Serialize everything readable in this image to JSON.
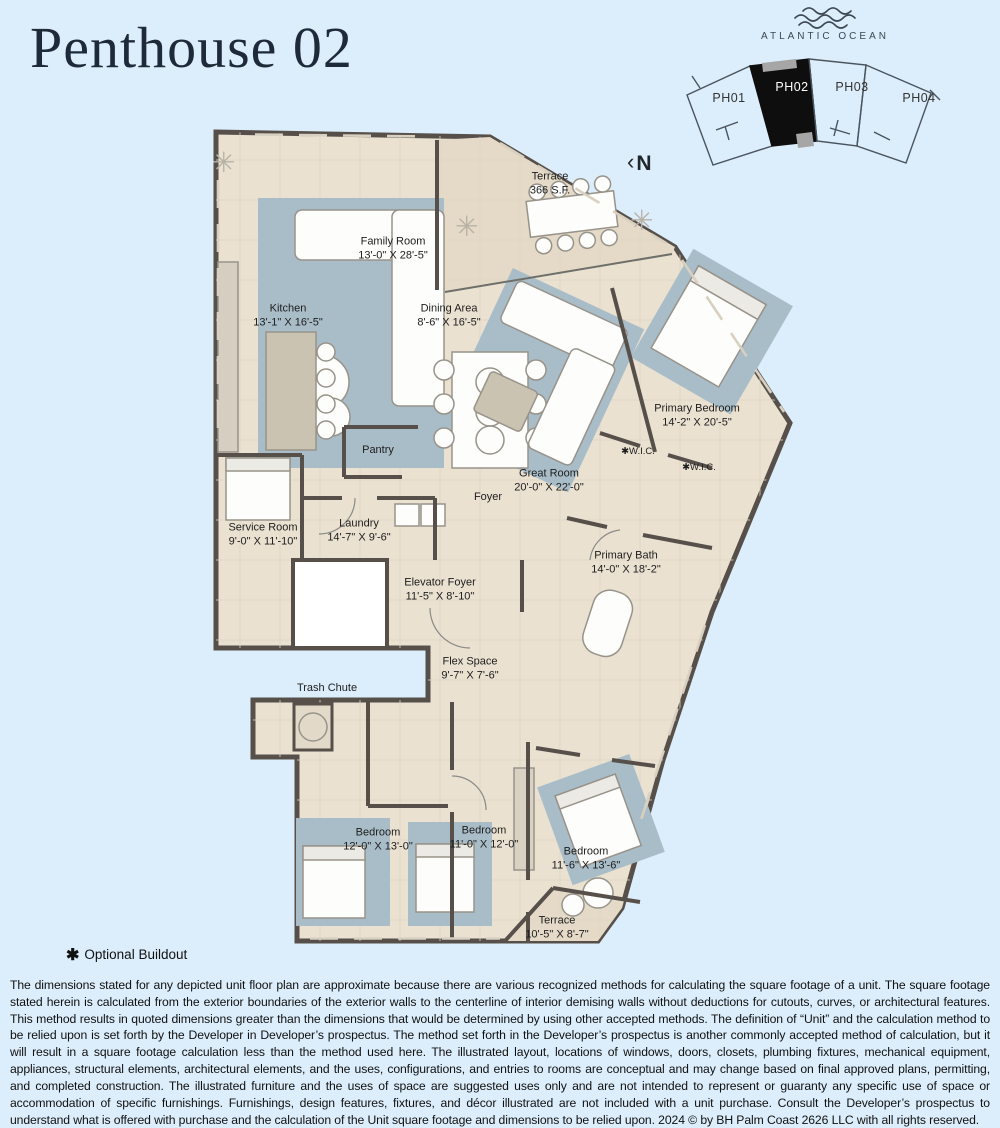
{
  "page": {
    "title": "Penthouse 02"
  },
  "key_plan": {
    "ocean_label": "ATLANTIC OCEAN",
    "north_label": "N",
    "north_chevron": "‹",
    "highlighted_unit": "PH02",
    "units": [
      {
        "id": "PH01"
      },
      {
        "id": "PH02"
      },
      {
        "id": "PH03"
      },
      {
        "id": "PH04"
      }
    ],
    "colors": {
      "highlight_fill": "#0e0e0e",
      "outline": "#4a545e"
    }
  },
  "floor_plan": {
    "rooms": [
      {
        "name": "Terrace",
        "dims": "366 S.F."
      },
      {
        "name": "Family Room",
        "dims": "13'-0\" X 28'-5\""
      },
      {
        "name": "Kitchen",
        "dims": "13'-1\" X 16'-5\""
      },
      {
        "name": "Dining Area",
        "dims": "8'-6\" X 16'-5\""
      },
      {
        "name": "Primary Bedroom",
        "dims": "14'-2\" X 20'-5\""
      },
      {
        "name": "Great Room",
        "dims": "20'-0\" X 22'-0\""
      },
      {
        "name": "✱W.I.C."
      },
      {
        "name": "✱W.I.C."
      },
      {
        "name": "Pantry"
      },
      {
        "name": "Foyer"
      },
      {
        "name": "Service Room",
        "dims": "9'-0\" X 11'-10\""
      },
      {
        "name": "Laundry",
        "dims": "14'-7\" X 9'-6\""
      },
      {
        "name": "Primary Bath",
        "dims": "14'-0\" X 18'-2\""
      },
      {
        "name": "Elevator Foyer",
        "dims": "11'-5\" X 8'-10\""
      },
      {
        "name": "Flex Space",
        "dims": "9'-7\" X 7'-6\""
      },
      {
        "name": "Trash Chute"
      },
      {
        "name": "Bedroom",
        "dims": "12'-0\" X 13'-0\""
      },
      {
        "name": "Bedroom",
        "dims": "11'-0\" X 12'-0\""
      },
      {
        "name": "Bedroom",
        "dims": "11'-6\" X 13'-6\""
      },
      {
        "name": "Terrace",
        "dims": "10'-5\" X 8'-7\""
      }
    ],
    "colors": {
      "background": "#dceefb",
      "floor": "#eae1d1",
      "terrace_floor": "#e4dac7",
      "walls": "#57504a",
      "rug": "#a9bdc9"
    }
  },
  "footnote": {
    "symbol": "✱",
    "label": "Optional Buildout"
  },
  "disclaimer": "The dimensions stated for any depicted unit floor plan are approximate because there are various recognized methods for calculating the square footage of a unit. The square footage stated herein is calculated from the exterior boundaries of the exterior walls to the centerline of interior demising walls without deductions for cutouts, curves, or architectural features. This method results in quoted dimensions greater than the dimensions that would be determined by using other accepted methods. The definition of “Unit” and the calculation method to be relied upon is set forth by the Developer in Developer’s prospectus. The method set forth in the Developer’s prospectus is another commonly accepted method of calculation, but it will result in a square footage calculation less than the method used here. The illustrated layout, locations of windows, doors, closets, plumbing fixtures, mechanical equipment, appliances, structural elements, architectural elements, and the uses, configurations, and entries to rooms are conceptual and may change based on final approved plans, permitting, and completed construction. The illustrated furniture and the uses of space are suggested uses only and are not intended to represent or guaranty any specific use of space or accommodation of specific furnishings. Furnishings, design features, fixtures, and décor illustrated are not included with a unit purchase. Consult the Developer’s prospectus to understand what is offered with purchase and the calculation of the Unit square footage and dimensions to be relied upon. 2024 © by BH Palm Coast 2626 LLC with all rights reserved."
}
